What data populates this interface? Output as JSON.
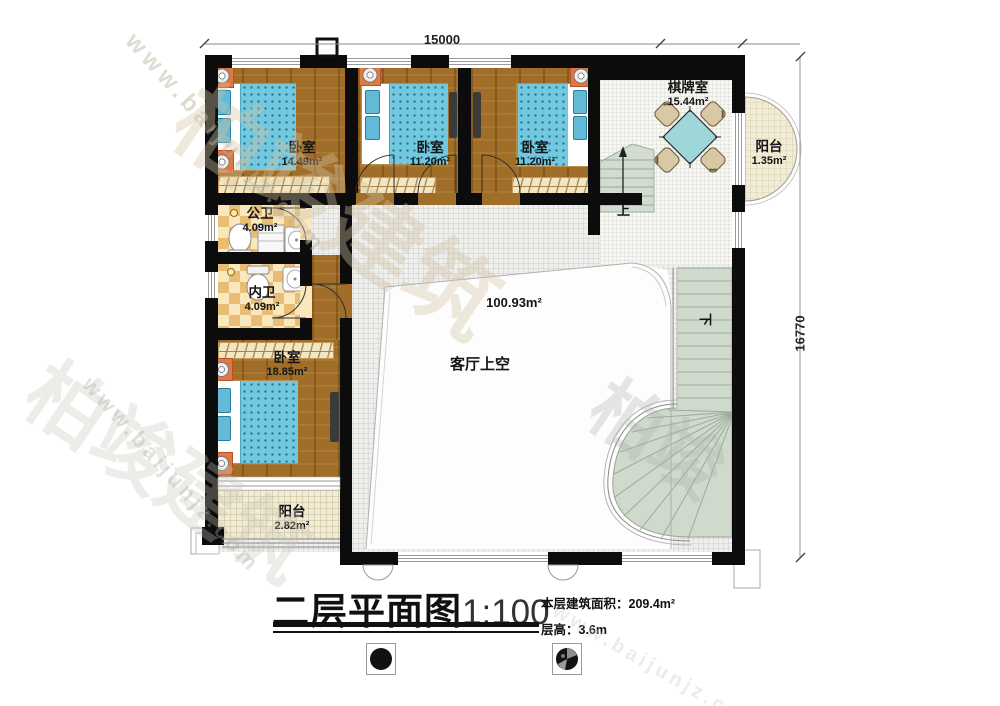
{
  "dimensions": {
    "top": "15000",
    "right": "16770"
  },
  "rooms": {
    "bedroom1": {
      "name": "卧室",
      "area": "14.49m²"
    },
    "bedroom2": {
      "name": "卧室",
      "area": "11.20m²"
    },
    "bedroom3": {
      "name": "卧室",
      "area": "11.20m²"
    },
    "bedroom4": {
      "name": "卧室",
      "area": "18.85m²"
    },
    "chess_room": {
      "name": "棋牌室",
      "area": "15.44m²"
    },
    "balcony_right": {
      "name": "阳台",
      "area": "1.35m²"
    },
    "balcony_bottom": {
      "name": "阳台",
      "area": "2.82m²"
    },
    "public_bath": {
      "name": "公卫",
      "area": "4.09m²"
    },
    "inner_bath": {
      "name": "内卫",
      "area": "4.09m²"
    },
    "living_void": {
      "name": "客厅上空",
      "area": "100.93m²"
    }
  },
  "stairs": {
    "up": "上",
    "down": "下"
  },
  "footer": {
    "title": "二层平面图",
    "scale": "1:100",
    "area_line": "本层建筑面积：209.4m²",
    "height_line": "层高：3.6m"
  },
  "watermark": {
    "site": "www.baijunjz.com",
    "brand": "柏竣建筑",
    "brand_short": "柏竣"
  },
  "colors": {
    "wall": "#0c0c0c",
    "wood": "#a06e28",
    "bedding": "#72c8de",
    "stair": "#cfd9cc",
    "tile": "#e9bd74",
    "table": "#9ed6da"
  }
}
